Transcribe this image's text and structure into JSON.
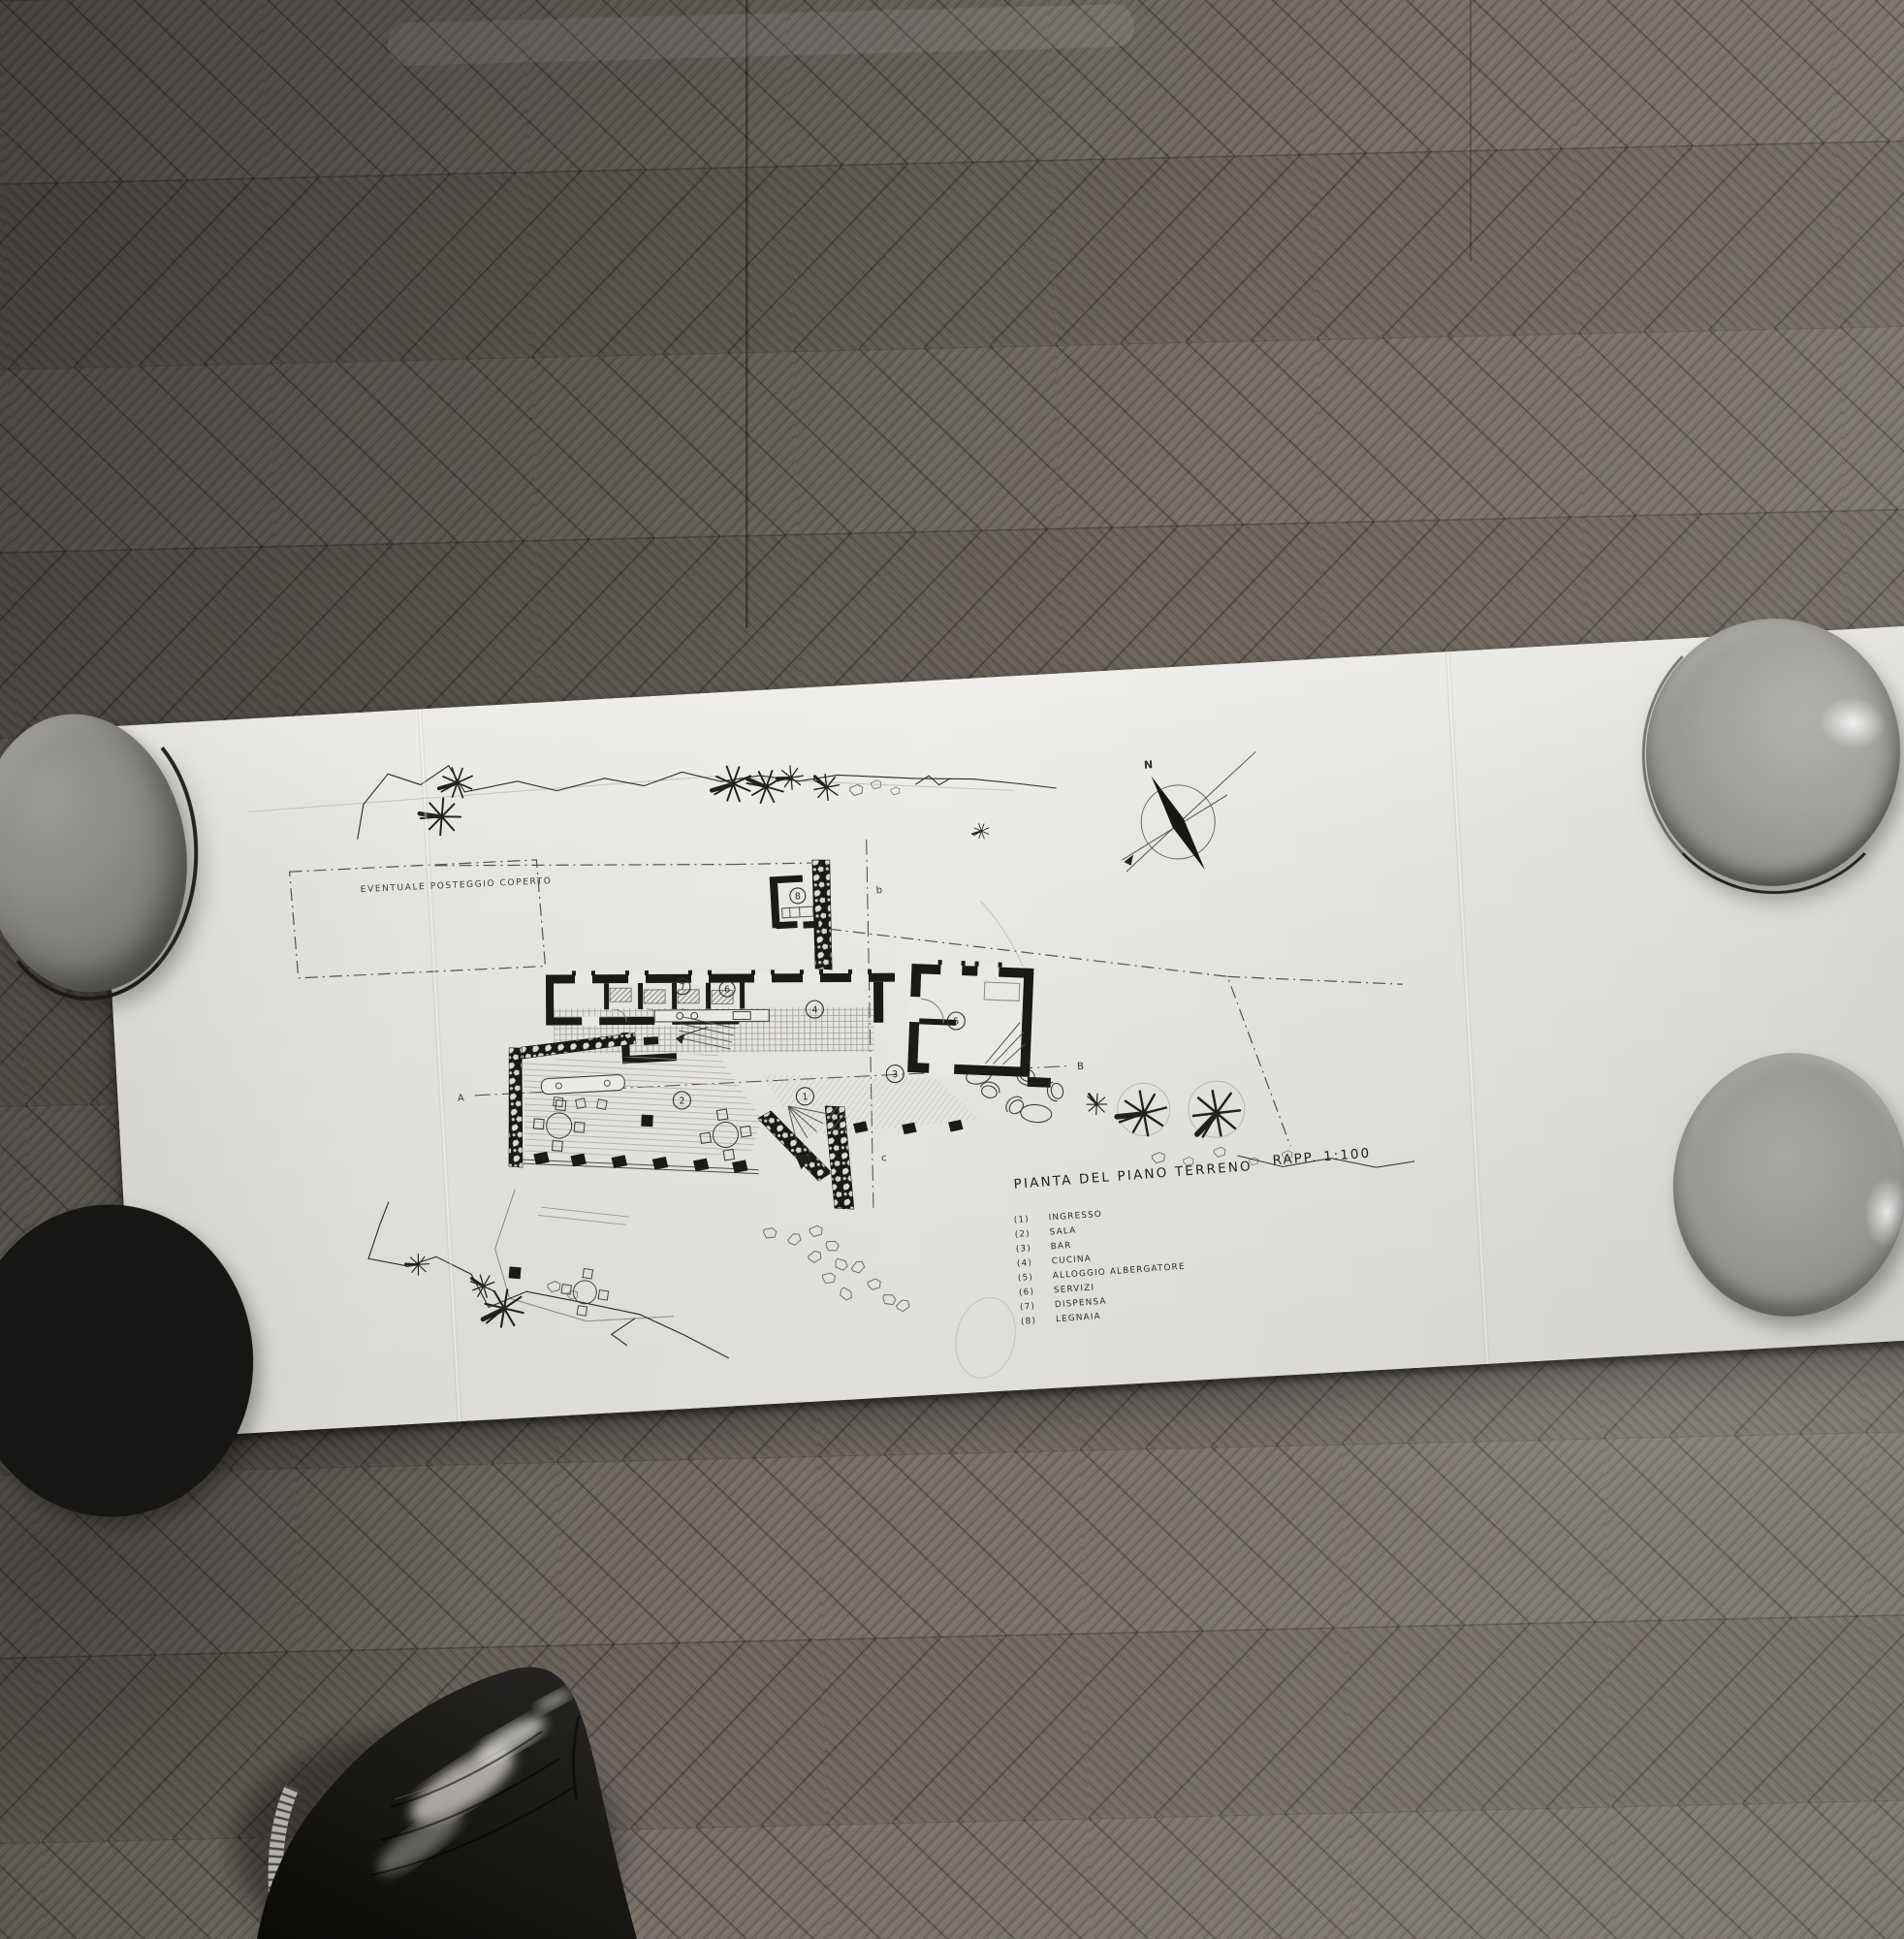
{
  "drawing": {
    "title": "PIANTA DEL PIANO TERRENO",
    "scale": "RAPP. 1:100",
    "legend": [
      {
        "num": "(1)",
        "label": "INGRESSO"
      },
      {
        "num": "(2)",
        "label": "SALA"
      },
      {
        "num": "(3)",
        "label": "BAR"
      },
      {
        "num": "(4)",
        "label": "CUCINA"
      },
      {
        "num": "(5)",
        "label": "ALLOGGIO ALBERGATORE"
      },
      {
        "num": "(6)",
        "label": "SERVIZI"
      },
      {
        "num": "(7)",
        "label": "DISPENSA"
      },
      {
        "num": "(8)",
        "label": "LEGNAIA"
      }
    ],
    "annotation_parking": "EVENTUALE POSTEGGIO COPERTO",
    "compass_north": "N",
    "section_labels": {
      "a": "A",
      "b": "B",
      "cut_b": "b",
      "cut_c": "c"
    },
    "room_circles": {
      "c1": "1",
      "c2": "2",
      "c3": "3",
      "c4": "4",
      "c5": "5",
      "c6": "6",
      "c7": "7",
      "c8": "8"
    }
  },
  "colors": {
    "paper": "#e4e3df",
    "ink": "#1a1a18",
    "floor_dark": "#524e49",
    "floor_mid": "#746e67",
    "floor_light": "#9a948c",
    "bowl_gray": "#8f8e8b",
    "shoe_black": "#141412"
  }
}
